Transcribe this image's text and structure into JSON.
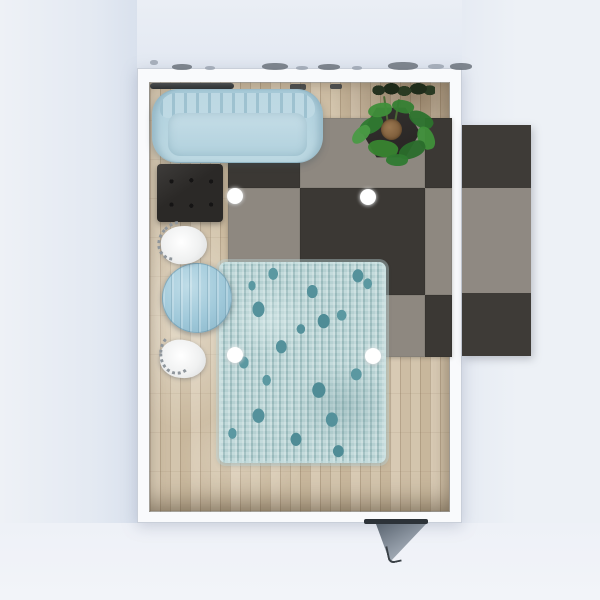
{
  "scene": {
    "view": "top-down floor plan render",
    "room_label": "Living room",
    "no_visible_text": true
  },
  "palette": {
    "background": "#ecf0f6",
    "wall_white": "#f9fafc",
    "wood_floor": "#d2c3ab",
    "tile_gray": "#8e8880",
    "tile_dark": "#3b3834",
    "sofa_blue": "#b5d4e0",
    "table_blue": "#a0c9da",
    "rug_teal_base": "#b2d0d1",
    "rug_teal_spot": "#54919b",
    "ottoman_dark": "#2b2927",
    "plant_green": "#3f8f3a",
    "planter_dark": "#2f2c2a",
    "soil_brown": "#8a6b45",
    "door_gray": "#4f5a66",
    "light_dot": "#ffffff"
  },
  "objects": {
    "room": {
      "label": "Living room with white walls"
    },
    "wood_floor": {
      "label": "Light wood plank flooring"
    },
    "checker_rug": {
      "label": "Checkered gray and charcoal carpet tiles"
    },
    "checker_rug_overflow": {
      "label": "Checkered carpet continuing outside right wall"
    },
    "blue_rug": {
      "label": "Teal patterned area rug"
    },
    "sofa": {
      "label": "Light blue channel-tufted sofa"
    },
    "ottoman": {
      "label": "Dark tufted ottoman"
    },
    "table": {
      "label": "Round light blue table"
    },
    "chair_top": {
      "label": "White upholstered chair (upper)"
    },
    "chair_bottom": {
      "label": "White upholstered chair (lower)"
    },
    "plant": {
      "label": "Green plant in dark hexagonal planter"
    },
    "curtain_rod": {
      "label": "Dark rail along top wall"
    },
    "wall_foliage": {
      "label": "Dark foliage along top wall"
    },
    "door": {
      "label": "Door opening outward at bottom wall"
    },
    "lights": {
      "label": "Recessed ceiling spotlight",
      "count": 4
    }
  }
}
